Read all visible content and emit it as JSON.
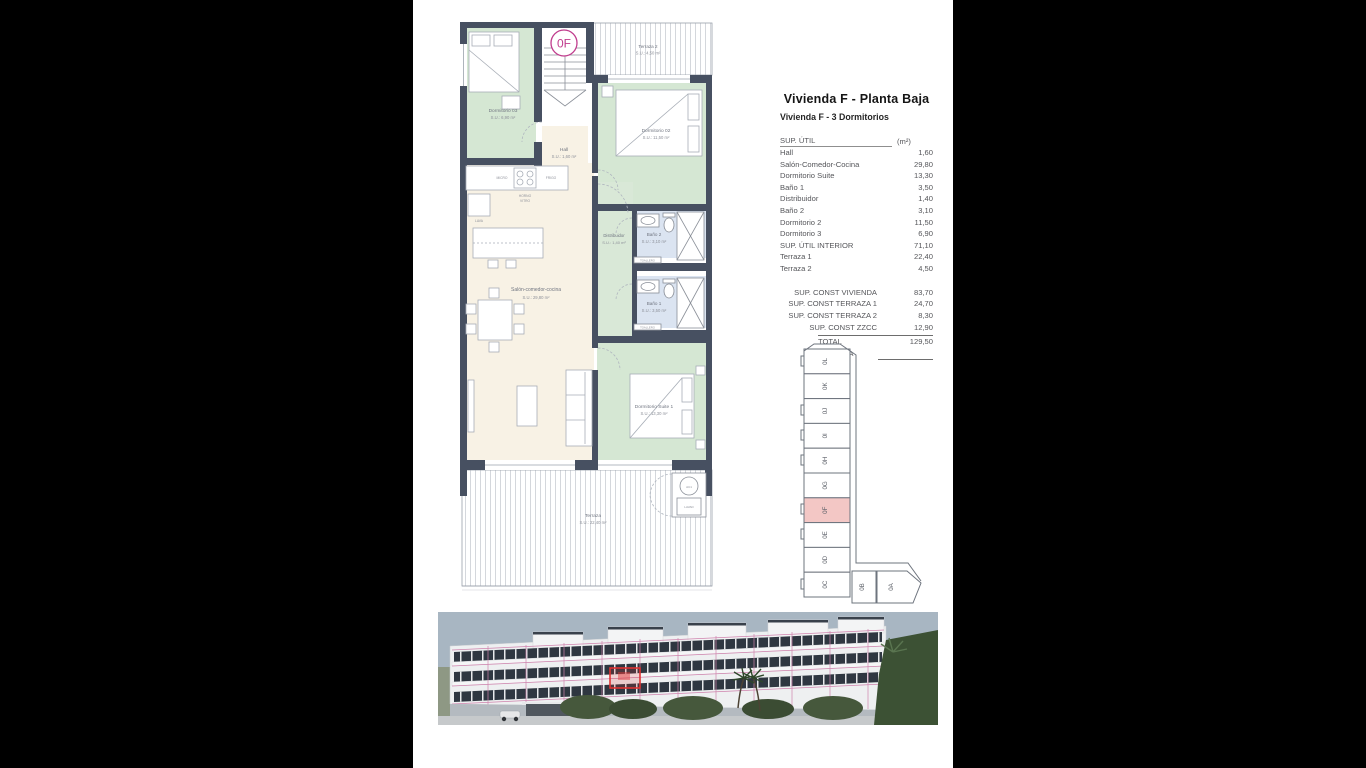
{
  "header": {
    "title": "Vivienda F - Planta Baja",
    "subtitle": "Vivienda F - 3 Dormitorios"
  },
  "area_table": {
    "header": {
      "label": "SUP. ÚTIL",
      "unit": "(m²)"
    },
    "rows": [
      {
        "label": "Hall",
        "value": "1,60"
      },
      {
        "label": "Salón-Comedor-Cocina",
        "value": "29,80"
      },
      {
        "label": "Dormitorio Suite",
        "value": "13,30"
      },
      {
        "label": "Baño 1",
        "value": "3,50"
      },
      {
        "label": "Distribuidor",
        "value": "1,40"
      },
      {
        "label": "Baño 2",
        "value": "3,10"
      },
      {
        "label": "Dormitorio 2",
        "value": "11,50"
      },
      {
        "label": "Dormitorio 3",
        "value": "6,90"
      },
      {
        "label": "SUP. ÚTIL INTERIOR",
        "value": "71,10"
      },
      {
        "label": "Terraza 1",
        "value": "22,40"
      },
      {
        "label": "Terraza 2",
        "value": "4,50"
      }
    ],
    "summary_rows": [
      {
        "label": "SUP. CONST VIVIENDA",
        "value": "83,70"
      },
      {
        "label": "SUP. CONST TERRAZA 1",
        "value": "24,70"
      },
      {
        "label": "SUP. CONST TERRAZA 2",
        "value": "8,30"
      },
      {
        "label": "SUP. CONST ZZCC",
        "value": "12,90"
      }
    ],
    "total": {
      "label": "TOTAL VIVIENDA",
      "value": "129,50"
    }
  },
  "floor_plan": {
    "unit_badge": "0F",
    "rooms": {
      "dormitorio3": {
        "name": "Dormitorio 03",
        "area": "S.U.: 6,90 m²"
      },
      "terraza2": {
        "name": "Terraza 2",
        "area": "S.U.: 4,50 m²"
      },
      "dormitorio2": {
        "name": "Dormitorio 02",
        "area": "S.U.: 11,50 m²"
      },
      "hall": {
        "name": "Hall",
        "area": "S.U.: 1,60 m²"
      },
      "salon": {
        "name": "Salón-comedor-cocina",
        "area": "S.U.: 29,80 m²"
      },
      "distribuidor": {
        "name": "Distribuidor",
        "area": "S.U.: 1,40 m²"
      },
      "bano2": {
        "name": "Baño 2",
        "area": "S.U.: 3,10 m²"
      },
      "bano1": {
        "name": "Baño 1",
        "area": "S.U.: 3,50 m²"
      },
      "suite": {
        "name": "Dormitorio Suite 1",
        "area": "S.U.: 13,30 m²"
      },
      "terraza": {
        "name": "Terraza",
        "area": "S.U.: 22,40 m²"
      }
    },
    "fixtures": {
      "micro": "MICRO",
      "frigo": "FRIGO",
      "horno": "HORNO",
      "vitro": "VITRO",
      "lava": "LAVA",
      "toallero1": "TOALLERO",
      "toallero2": "TOALLERO",
      "ac": "AC1",
      "lavad": "LAVAD"
    }
  },
  "location_strip": {
    "highlighted_unit": "0F",
    "units": [
      "0L",
      "0K",
      "0J",
      "0I",
      "0H",
      "0G",
      "0F",
      "0E",
      "0D",
      "0C"
    ],
    "bottom_units": [
      "0B",
      "0A"
    ]
  },
  "colors": {
    "wall": "#475061",
    "room_green": "#d5e7d3",
    "room_cream": "#f8f2e5",
    "room_blue": "#dbe4f1",
    "highlight_pink": "#f3c7c5",
    "badge_magenta": "#c03c8d",
    "render_grid_pink": "#cf83ad",
    "render_highlight_red": "#e03333"
  }
}
